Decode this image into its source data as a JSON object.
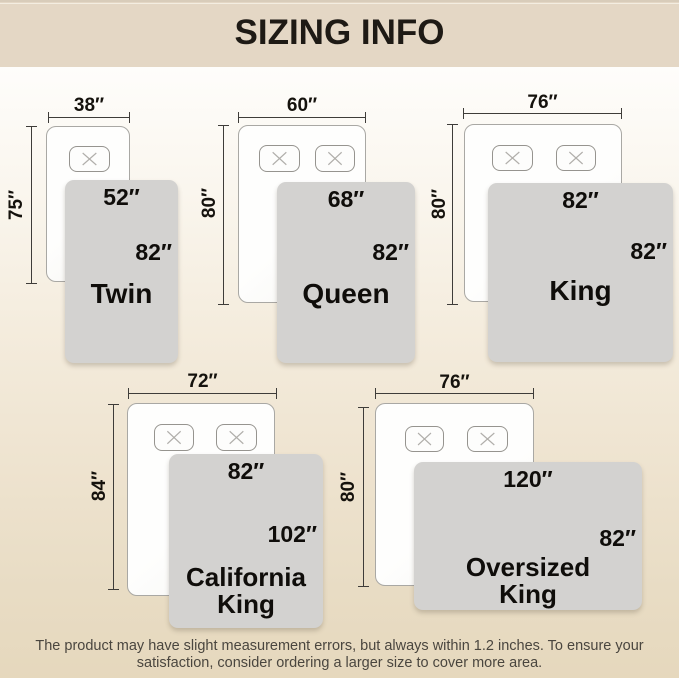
{
  "page": {
    "title": "SIZING INFO",
    "note": "The product may have slight measurement errors, but always within 1.2 inches. To ensure your satisfaction, consider ordering a larger size to cover more area."
  },
  "colors": {
    "header_bg": "#e4d7c5",
    "header_text": "#1e1a15",
    "page_gradient_top": "#fefdfb",
    "page_gradient_bottom": "#e6d8bd",
    "blanket_gray": "#d3d2d0",
    "bed_fill": "#fdfdfc",
    "dim_line": "#3e3c39",
    "note_text": "#4a463f"
  },
  "icons": {
    "pillow_marker": "x-cross"
  },
  "sizes": [
    {
      "name": "Twin",
      "mattress_width": "38″",
      "mattress_length": "75″",
      "blanket_width": "52″",
      "blanket_length": "82″",
      "pillow_count": 1
    },
    {
      "name": "Queen",
      "mattress_width": "60″",
      "mattress_length": "80″",
      "blanket_width": "68″",
      "blanket_length": "82″",
      "pillow_count": 2
    },
    {
      "name": "King",
      "mattress_width": "76″",
      "mattress_length": "80″",
      "blanket_width": "82″",
      "blanket_length": "82″",
      "pillow_count": 2
    },
    {
      "name": "California King",
      "mattress_width": "72″",
      "mattress_length": "84″",
      "blanket_width": "82″",
      "blanket_length": "102″",
      "pillow_count": 2
    },
    {
      "name": "Oversized King",
      "mattress_width": "76″",
      "mattress_length": "80″",
      "blanket_width": "120″",
      "blanket_length": "82″",
      "pillow_count": 2
    }
  ]
}
